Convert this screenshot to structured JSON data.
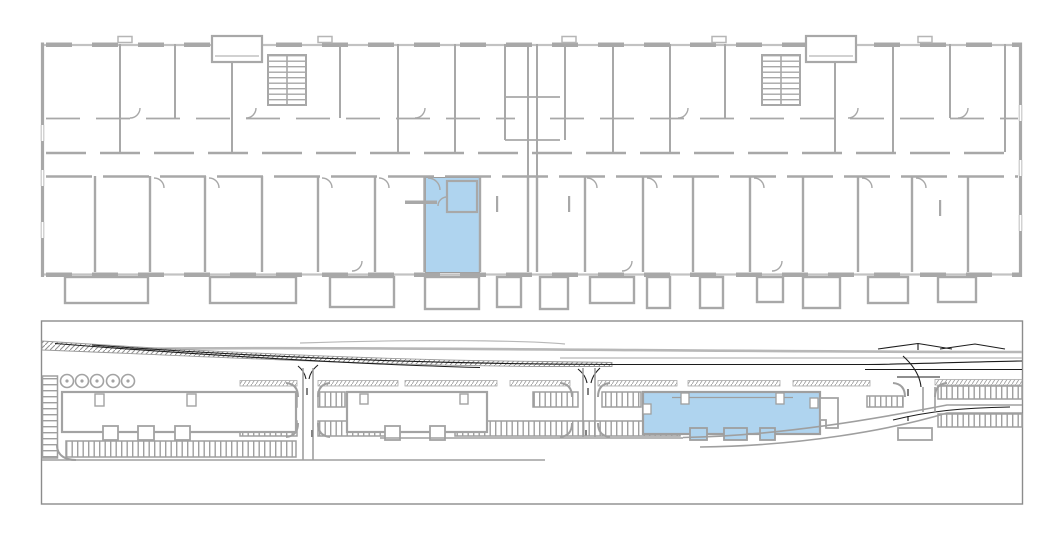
{
  "canvas": {
    "width": 1062,
    "height": 534,
    "background_color": "#ffffff"
  },
  "colors": {
    "highlight_fill": "#afd4ef",
    "highlight_stroke": "#9b9b9b",
    "wall_gray": "#a8a8a8",
    "window_gray": "#c2c2c2",
    "site_gray": "#9f9f9f",
    "site_light_gray": "#b8b8b8",
    "road_marking_black": "#1c1c1c",
    "plan_border_gray": "#8c8c8c",
    "paper_white": "#ffffff"
  },
  "floor_plan": {
    "selected_unit": {
      "highlighted": true,
      "fill": "#afd4ef"
    },
    "stairwell_count": 2,
    "entrance_vestibule_count": 2,
    "balcony_count": 13
  },
  "site_plan": {
    "selected_building": {
      "highlighted": true,
      "fill": "#afd4ef"
    },
    "building_count": 3,
    "tree_count": 5,
    "road_junction_count": 3
  }
}
